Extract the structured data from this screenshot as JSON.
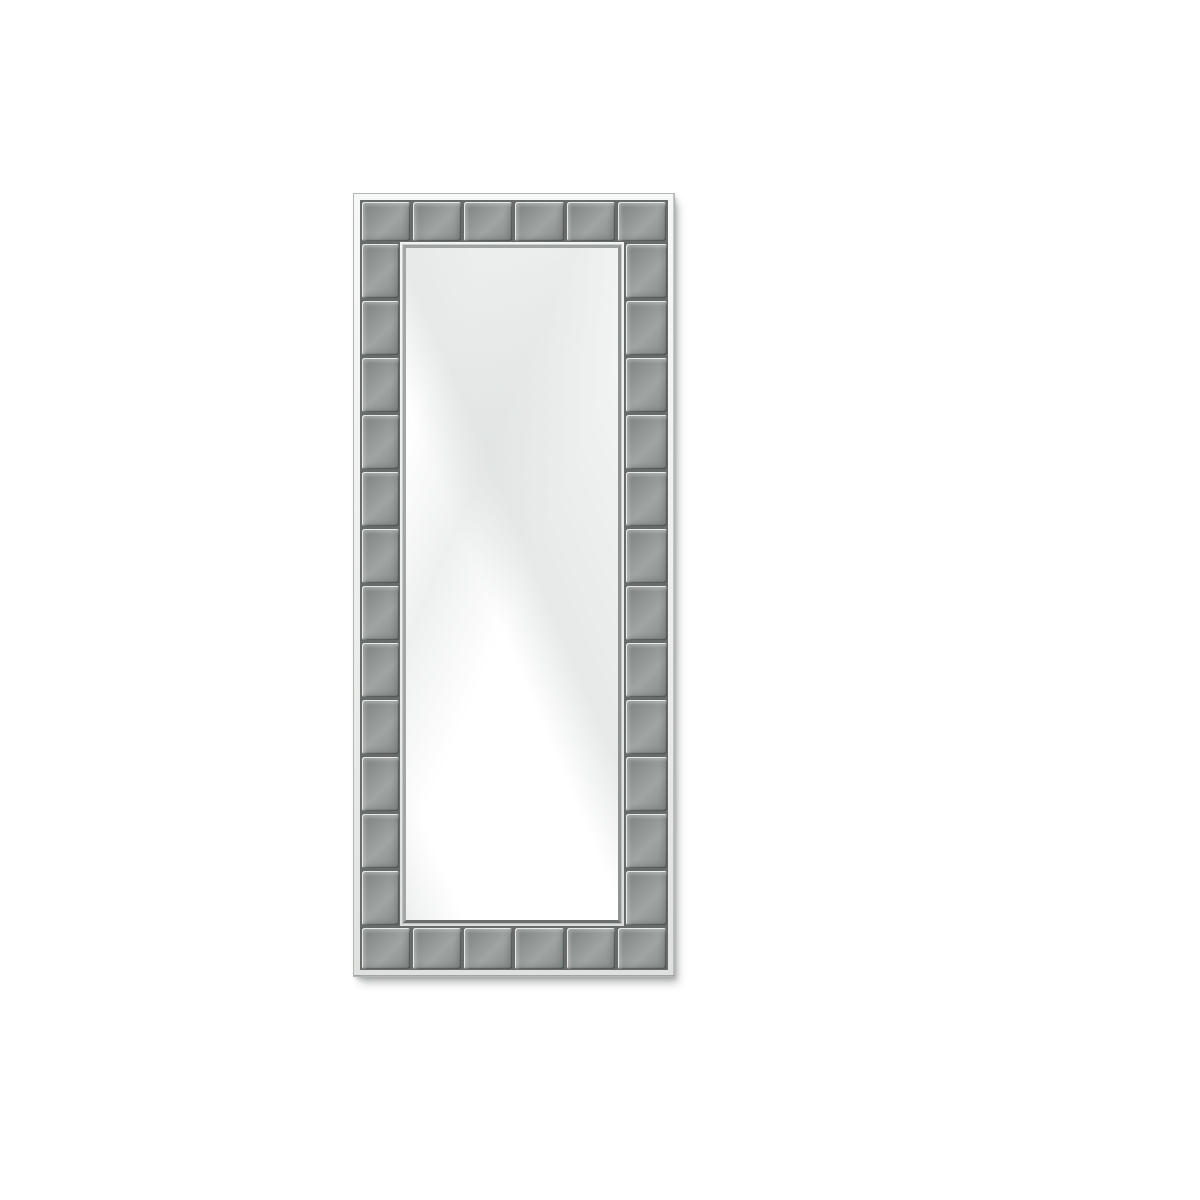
{
  "scene": {
    "type": "product-photo",
    "description": "Tall rectangular wall mirror with a gray beveled glass-tile mosaic frame, shown on a plain white background with a soft drop shadow to the lower right",
    "background_color": "#ffffff"
  },
  "mirror": {
    "position": {
      "left": 353,
      "top": 193,
      "width": 322,
      "height": 784
    },
    "frame": {
      "style": "square beveled glass tiles with dark grooves and polished silver trim",
      "tile_counts": {
        "top": 6,
        "bottom": 6,
        "left": 12,
        "right": 12
      }
    },
    "glass": {
      "finish": "clear mirror with diagonal light reflection running from lower-left to upper-right"
    }
  },
  "colors": {
    "background": "#ffffff",
    "outer_trim": "#eceeed",
    "outer_hairline": "#b3b6b5",
    "groove": "#676c6b",
    "tile_face": "#a0a5a3",
    "tile_edge": "#7c8180",
    "inner_trim": "#e9eaea",
    "bevel_top": "#9ea3a2",
    "bevel_right": "#8f9493",
    "bevel_bottom": "#6a6f6e",
    "bevel_left": "#a2a7a6",
    "glass_base": "#ffffff",
    "shadow_color": "rgba(110,114,113,0.42)"
  }
}
